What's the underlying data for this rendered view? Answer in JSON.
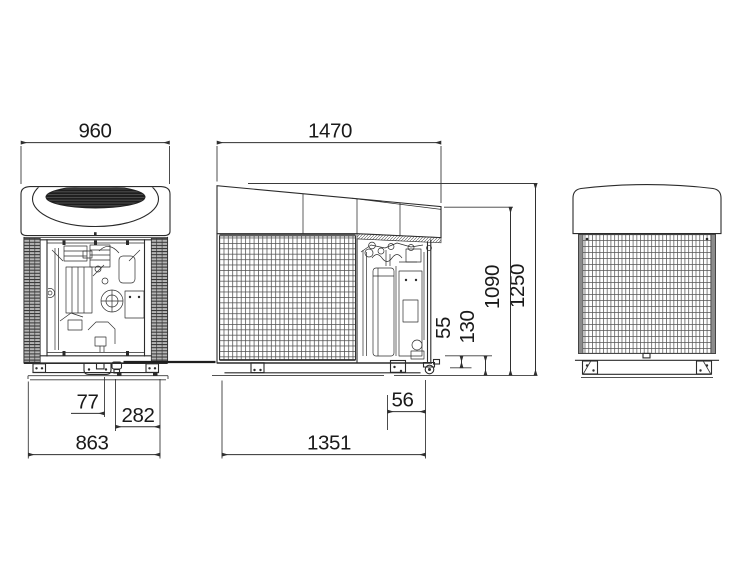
{
  "dimensions": {
    "front_width": "960",
    "side_length": "1470",
    "front_mount_offset": "77",
    "front_mount_spacing": "282",
    "front_base_width": "863",
    "side_drain_offset": "56",
    "side_base_length": "1351",
    "drain_clearance": "55",
    "base_height": "130",
    "cover_height": "1090",
    "overall_height": "1250"
  },
  "colors": {
    "line": "#2b2b2b",
    "text": "#1a1a1a",
    "mesh": "#4f4f4f",
    "panel": "#ffffff"
  }
}
